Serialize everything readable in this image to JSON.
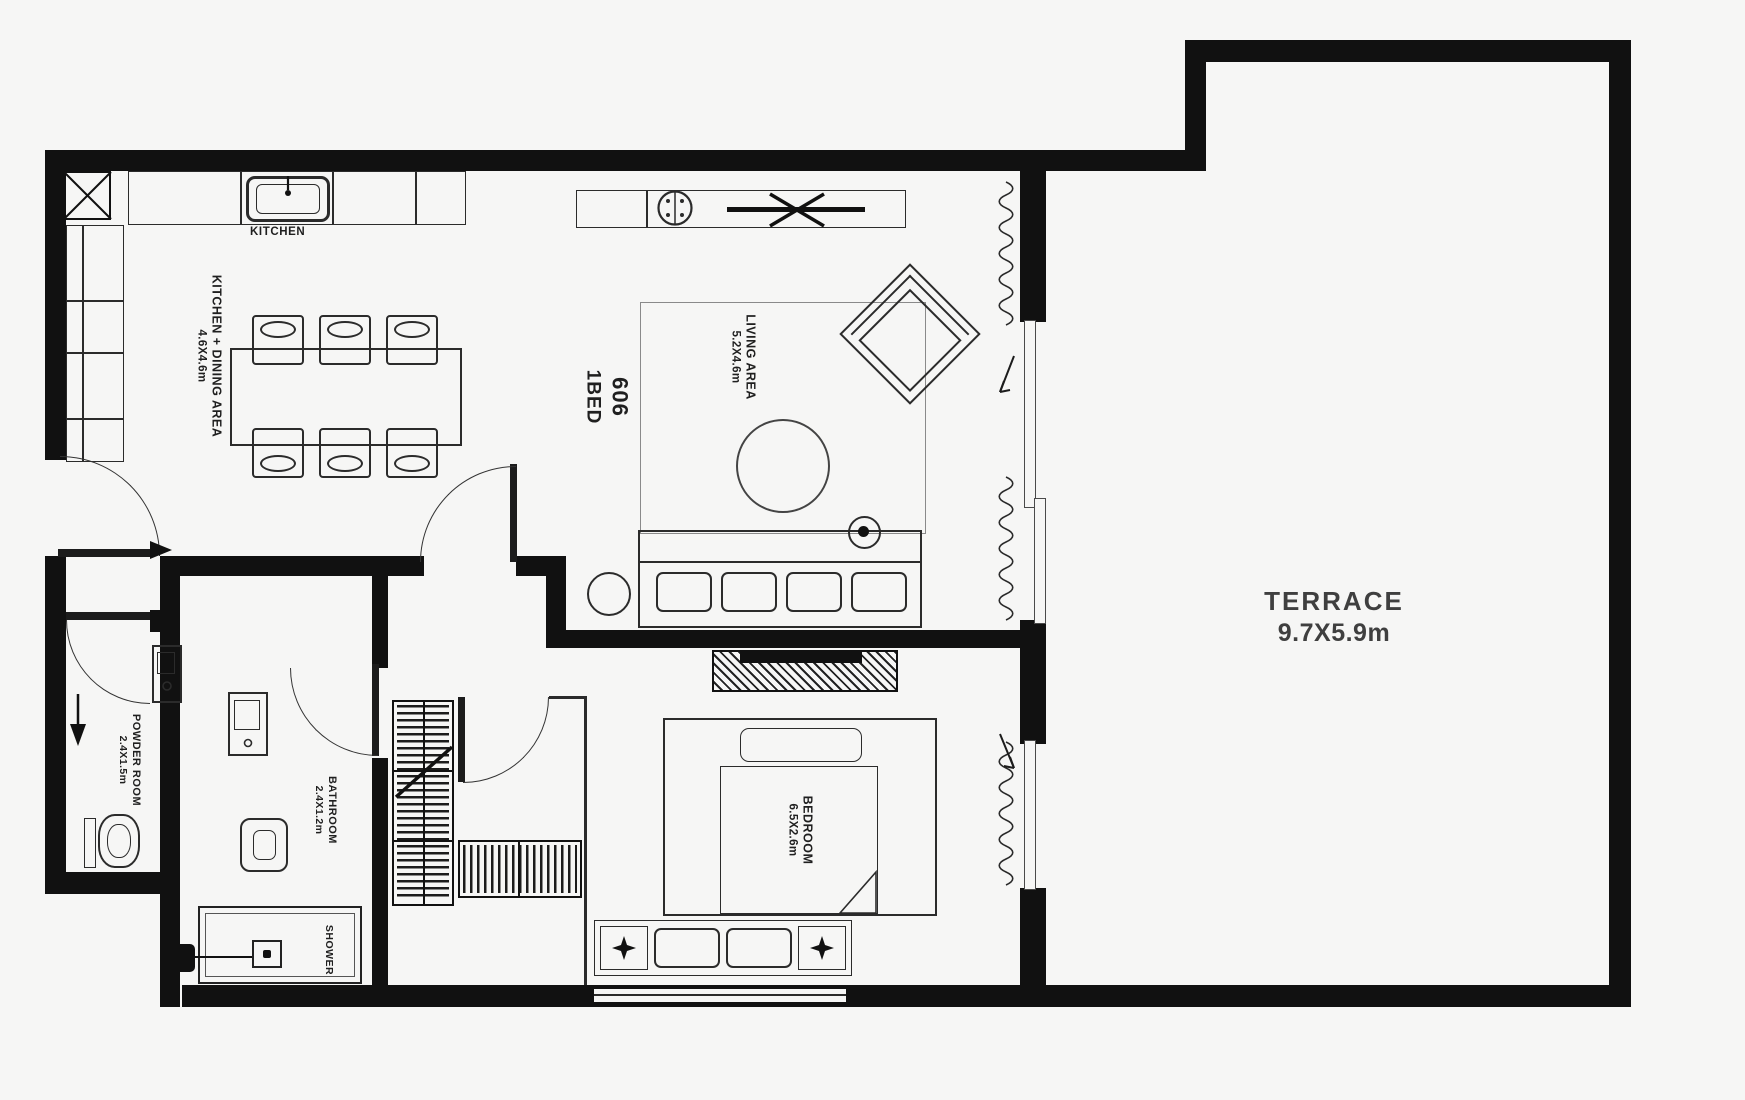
{
  "unit": {
    "number": "606",
    "type": "1BED"
  },
  "rooms": {
    "kitchen_dining": {
      "name": "KITCHEN + DINING AREA",
      "dims": "4.6X4.6m"
    },
    "living": {
      "name": "LIVING AREA",
      "dims": "5.2X4.6m"
    },
    "bedroom": {
      "name": "BEDROOM",
      "dims": "6.5X2.6m"
    },
    "powder": {
      "name": "POWDER ROOM",
      "dims": "2.4X1.5m"
    },
    "bathroom": {
      "name": "BATHROOM",
      "dims": "2.4X1.2m"
    },
    "shower": {
      "name": "SHOWER"
    },
    "terrace": {
      "name": "TERRACE",
      "dims": "9.7X5.9m"
    }
  },
  "fixtures": {
    "kitchen": "KITCHEN"
  },
  "colors": {
    "wall": "#111111",
    "line": "#2b2b2b",
    "background": "#f6f6f5",
    "label_text": "#1f1f1f",
    "terrace_text": "#3f3f3f"
  }
}
